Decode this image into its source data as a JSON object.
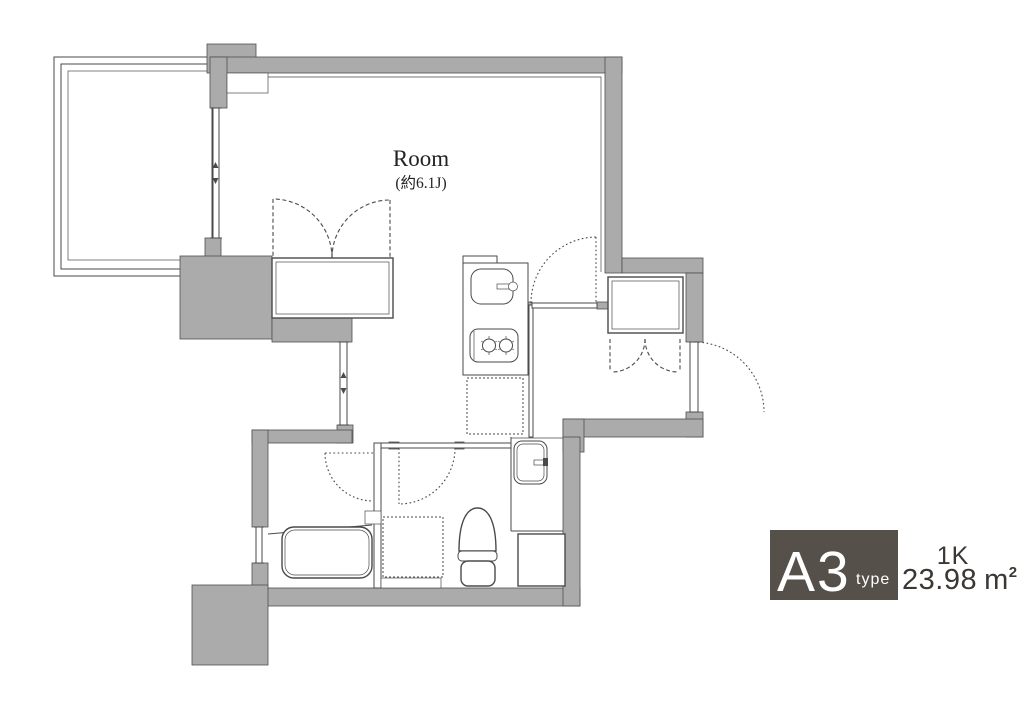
{
  "plan": {
    "room": {
      "label": "Room",
      "size": "(約6.1J)"
    }
  },
  "legend": {
    "type_letter": "A",
    "type_digit": "3",
    "type_word": "type",
    "layout_type": "1K",
    "area_value": "23.98",
    "area_unit": "m",
    "area_superscript": "2"
  },
  "colors": {
    "wall": "#ababab",
    "wall_stroke": "#4f4f4f",
    "line": "#4a4a4a",
    "label_box": "#56504a",
    "label_text": "#ffffff",
    "legend_text": "#3b3733",
    "background": "#ffffff",
    "room_text": "#222222"
  }
}
